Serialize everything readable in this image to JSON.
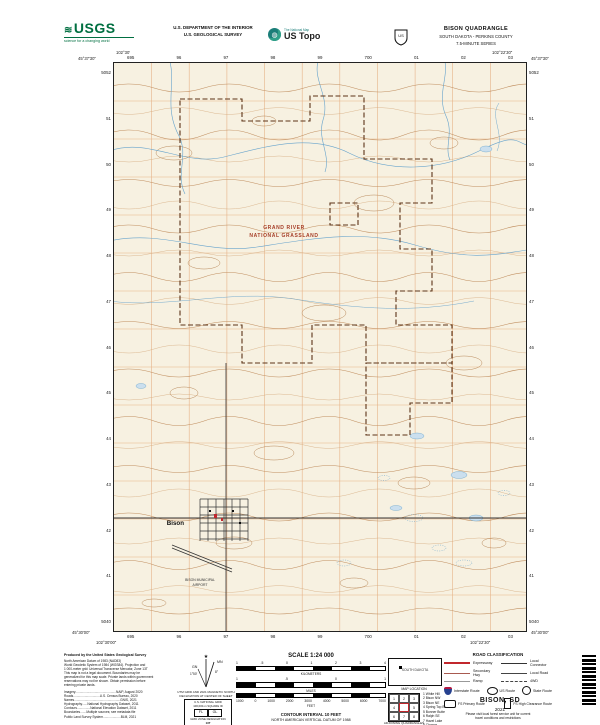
{
  "header": {
    "usgs_logo": {
      "wave_icon": "≋",
      "text": "USGS",
      "tagline": "science for a changing world"
    },
    "dept_line1": "U.S. DEPARTMENT OF THE INTERIOR",
    "dept_line2": "U.S. GEOLOGICAL SURVEY",
    "ustopo": {
      "brand": "The National Map",
      "name": "US Topo",
      "globe_icon": "◍"
    },
    "fs_shield_icon": "forest-service-shield",
    "title": "BISON QUADRANGLE",
    "subtitle": "SOUTH DAKOTA - PERKINS COUNTY",
    "series": "7.5-MINUTE SERIES"
  },
  "map": {
    "corners": {
      "tl_lat": "45°37'30\"",
      "tl_lon": "102°30'",
      "tr_lat": "45°37'30\"",
      "tr_lon": "102°22'30\"",
      "bl_lat": "45°30'00\"",
      "bl_lon": "102°30'00\"",
      "br_lat": "45°30'00\"",
      "br_lon": "102°22'30\""
    },
    "top_grid_labels": [
      "695",
      "96",
      "97",
      "98",
      "99",
      "700",
      "01",
      "02",
      "03"
    ],
    "bottom_grid_labels": [
      "695",
      "96",
      "97",
      "98",
      "99",
      "700",
      "01",
      "02",
      "03"
    ],
    "left_grid_labels": [
      "5052",
      "51",
      "50",
      "49",
      "48",
      "47",
      "46",
      "45",
      "44",
      "43",
      "42",
      "41",
      "5040"
    ],
    "right_grid_labels": [
      "5052",
      "51",
      "50",
      "49",
      "48",
      "47",
      "46",
      "45",
      "44",
      "43",
      "42",
      "41",
      "5040"
    ],
    "grassland_label_line1": "GRAND RIVER",
    "grassland_label_line2": "NATIONAL GRASSLAND",
    "town_label": "Bison",
    "airport_label_line1": "BISON MUNICIPAL",
    "airport_label_line2": "AIRPORT",
    "colors": {
      "background": "#F7F1E1",
      "contour": "#C08E5F",
      "contour_light": "#D4A97C",
      "water": "#66A3CC",
      "water_fill": "#CBDFEE",
      "boundary": "#5C3317",
      "section_line": "#E4AC7E",
      "road": "#333333",
      "building_red": "#C1272D",
      "label_red": "#A63E28"
    }
  },
  "footer": {
    "credits_title": "Produced by the United States Geological Survey",
    "credits_lines": [
      "North American Datum of 1983 (NAD83)",
      "World Geodetic System of 1984 (WGS84).  Projection and",
      "1 000-meter grid: Universal Transverse Mercator, Zone 13T",
      "This map is not a legal document. Boundaries may be",
      "generalized for this map scale. Private lands within government",
      "reservations may not be shown. Obtain permission before",
      "entering private lands."
    ],
    "sources_lines": [
      "Imagery..............................................NAIP, August 2020",
      "Roads..............................U.S. Census Bureau, 2020",
      "Names....................................................GNIS, 2021",
      "Hydrography......National Hydrography Dataset, 2011",
      "Contours...............National Elevation Dataset, 2011",
      "Boundaries.......Multiple sources; see metadata file",
      "Public Land Survey System....................BLM, 2021"
    ],
    "declination": {
      "star_icon": "★",
      "gn_label": "GN",
      "mn_label": "MN",
      "gn_value": "1°50'",
      "mn_value": "8°",
      "caption_line1": "UTM GRID AND 2021 MAGNETIC NORTH",
      "caption_line2": "DECLINATION AT CENTER OF SHEET"
    },
    "usng": {
      "title": "U.S. NATIONAL GRID",
      "subtitle": "100,000-m SQUARE ID",
      "square_ids": [
        "FL",
        "GL"
      ],
      "zone_label": "GRID ZONE DESIGNATION",
      "zone": "13T"
    },
    "scale": {
      "label": "SCALE 1:24 000",
      "km_unit": "KILOMETERS",
      "km_ticks": [
        "1",
        ".5",
        "0",
        "1",
        "2",
        "3",
        "4"
      ],
      "miles_unit": "MILES",
      "miles_ticks": [
        "1",
        ".5",
        "0",
        "1"
      ],
      "feet_unit": "FEET",
      "feet_ticks": [
        "1000",
        "0",
        "1000",
        "2000",
        "3000",
        "4000",
        "5000",
        "6000",
        "7000"
      ],
      "contour_note_line1": "CONTOUR INTERVAL 10 FEET",
      "contour_note_line2": "NORTH AMERICAN VERTICAL DATUM OF 1988",
      "standard_note_line1": "This map was produced to conform with the",
      "standard_note_line2": "National Geospatial Program US Topo Product Standard, 2021."
    },
    "location": {
      "state_label": "SOUTH DAKOTA",
      "caption": "MAP LOCATION"
    },
    "adjoining": {
      "caption": "ADJOINING QUADRANGLES",
      "cells": [
        "1",
        "2",
        "3",
        "4",
        "",
        "5",
        "6",
        "7",
        "8"
      ],
      "names": [
        "1  White Hill",
        "2  Bison NW",
        "3  Bison NE",
        "4  Spring Top Butte",
        "5  Bonner Butte",
        "6  Ralph SE",
        "7  Hazel Lake",
        "8  Chance"
      ]
    },
    "road_class": {
      "title": "ROAD CLASSIFICATION",
      "rows": [
        {
          "label": "Expressway"
        },
        {
          "label": "Local Connector"
        },
        {
          "label": "Secondary Hwy"
        },
        {
          "label": "Local Road"
        },
        {
          "label": "Ramp"
        },
        {
          "label": "4WD"
        }
      ],
      "shields": [
        {
          "label": "Interstate Route"
        },
        {
          "label": "US Route"
        },
        {
          "label": "State Route"
        }
      ],
      "fs": [
        {
          "label": "FS Primary Route"
        },
        {
          "label": "FS High Clearance Route"
        }
      ],
      "note_line1": "Please visit local forest service unit for current",
      "note_line2": "travel conditions and restrictions"
    },
    "sheet": {
      "title": "BISON, SD",
      "year": "2021"
    }
  }
}
